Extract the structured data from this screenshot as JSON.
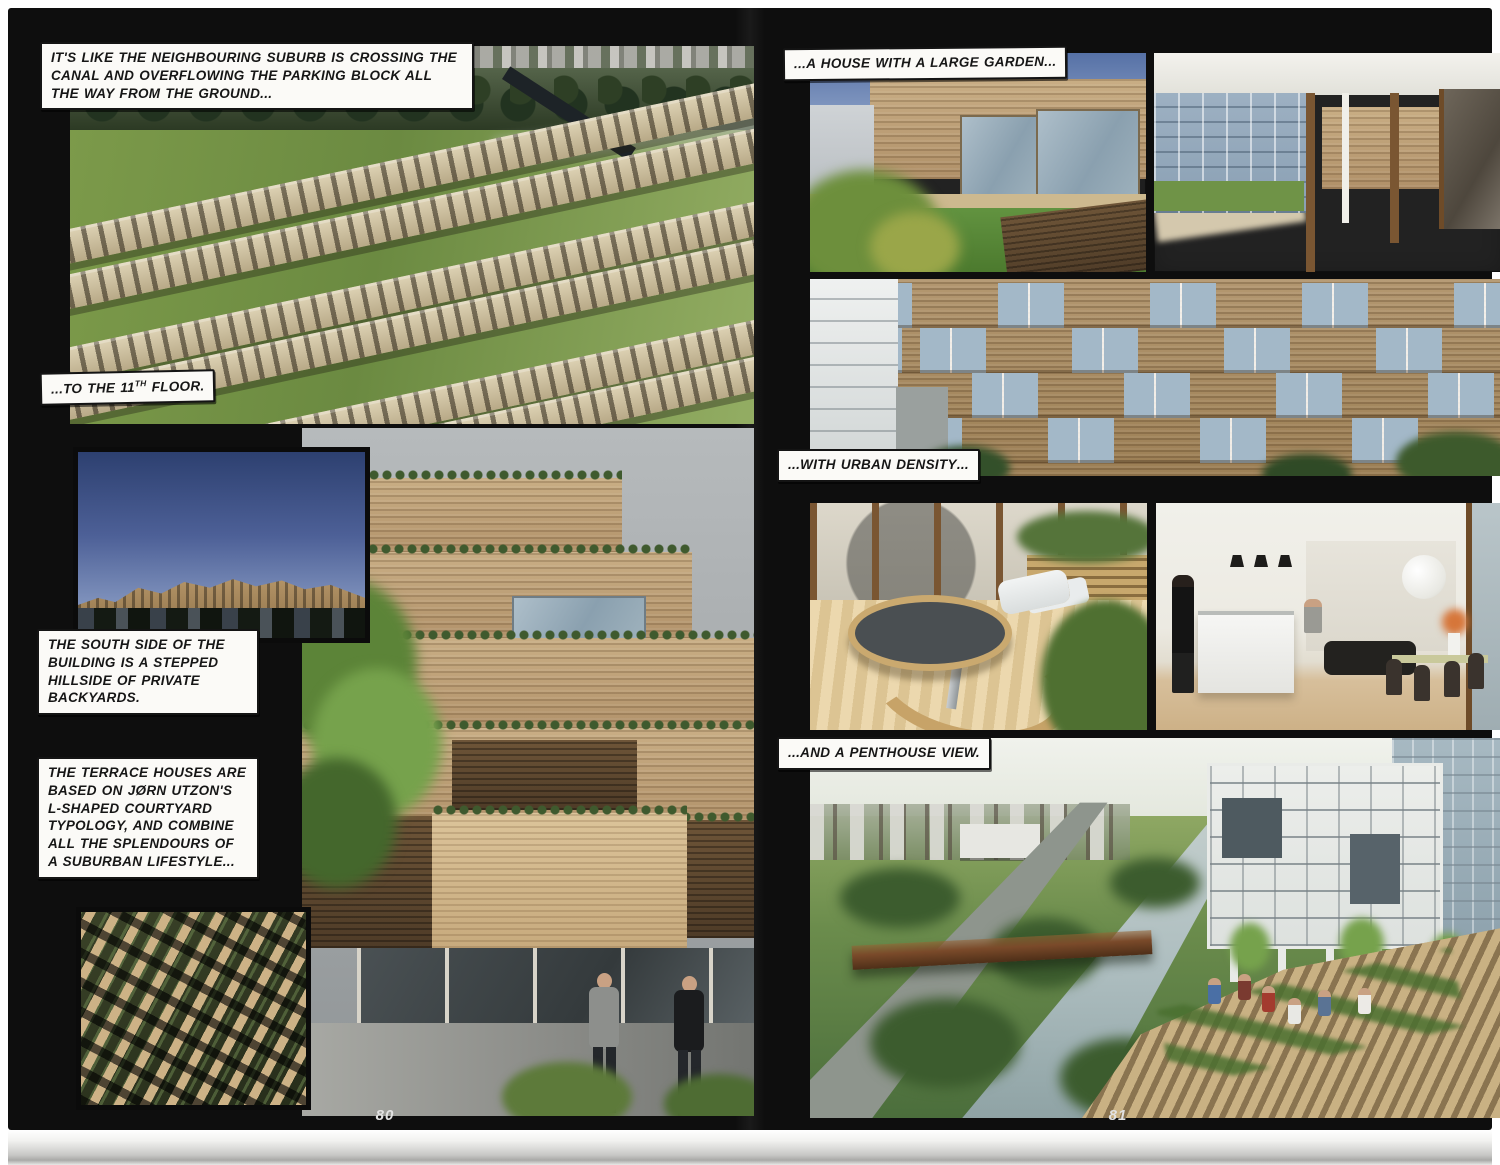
{
  "pages": {
    "left": {
      "number": "80"
    },
    "right": {
      "number": "81"
    }
  },
  "captions": {
    "overflow": [
      {
        "t": "IT'S LIKE THE ",
        "em": false
      },
      {
        "t": "NEIGHBOURING SUBURB",
        "em": true
      },
      {
        "t": " IS CROSSING THE CANAL AND ",
        "em": false
      },
      {
        "t": "OVERFLOWING THE PARKING BLOCK",
        "em": true
      },
      {
        "t": " ALL THE WAY FROM THE GROUND...",
        "em": false
      }
    ],
    "floor": [
      {
        "t": "...TO THE 11",
        "em": false
      },
      {
        "t": "TH",
        "em": false,
        "sup": true
      },
      {
        "t": " FLOOR.",
        "em": false
      }
    ],
    "south_side": [
      {
        "t": "THE SOUTH SIDE OF THE BUILDING IS A ",
        "em": false
      },
      {
        "t": "STEPPED HILLSIDE OF PRIVATE BACKYARDS.",
        "em": true
      }
    ],
    "terrace_houses": [
      {
        "t": "THE TERRACE HOUSES ARE BASED ON JØRN UTZON'S L-SHAPED COURTYARD TYPOLOGY, AND COMBINE ALL THE ",
        "em": false
      },
      {
        "t": "SPLENDOURS OF A SUBURBAN LIFESTYLE...",
        "em": true
      }
    ],
    "large_garden": [
      {
        "t": "...A HOUSE WITH A ",
        "em": false
      },
      {
        "t": "LARGE GARDEN",
        "em": true
      },
      {
        "t": "...",
        "em": false
      }
    ],
    "urban_density": [
      {
        "t": "...WITH ",
        "em": false
      },
      {
        "t": "URBAN DENSITY",
        "em": true
      },
      {
        "t": "...",
        "em": false
      }
    ],
    "penthouse_view": [
      {
        "t": "...AND A ",
        "em": false
      },
      {
        "t": "PENTHOUSE VIEW.",
        "em": true
      }
    ]
  },
  "photos": {
    "aerial_suburb": {
      "desc": "Aerial view of stepped wooden terraces with grass courtyards meeting a green suburb"
    },
    "mountain_building": {
      "desc": "Terraced mountain-shaped building against a blue sky"
    },
    "aerial_housing": {
      "desc": "Aerial grid of L-shaped courtyard terrace houses"
    },
    "stepped_building": {
      "desc": "Stepped wooden facade with planted terraces, a tree and two men walking below"
    },
    "house_garden": {
      "desc": "Wooden house volume with glass walls and a grass garden"
    },
    "terrace_interior": {
      "desc": "Covered roof terrace with wooden floor and glass walls"
    },
    "facade": {
      "desc": "Wooden facade with staggered blue glass balconies"
    },
    "terrace_table": {
      "desc": "Wooden deck with a round picnic table and curved bench"
    },
    "kitchen_interior": {
      "desc": "Open white kitchen and dining room with wooden floor"
    },
    "penthouse_view": {
      "desc": "View over a canal, bridge and green suburb from a planted roof terrace"
    }
  },
  "colors": {
    "page_paper": "#ffffff",
    "spread_background": "#0e0e0e",
    "caption_fill": "#fbfaf7",
    "caption_border": "#141414"
  }
}
